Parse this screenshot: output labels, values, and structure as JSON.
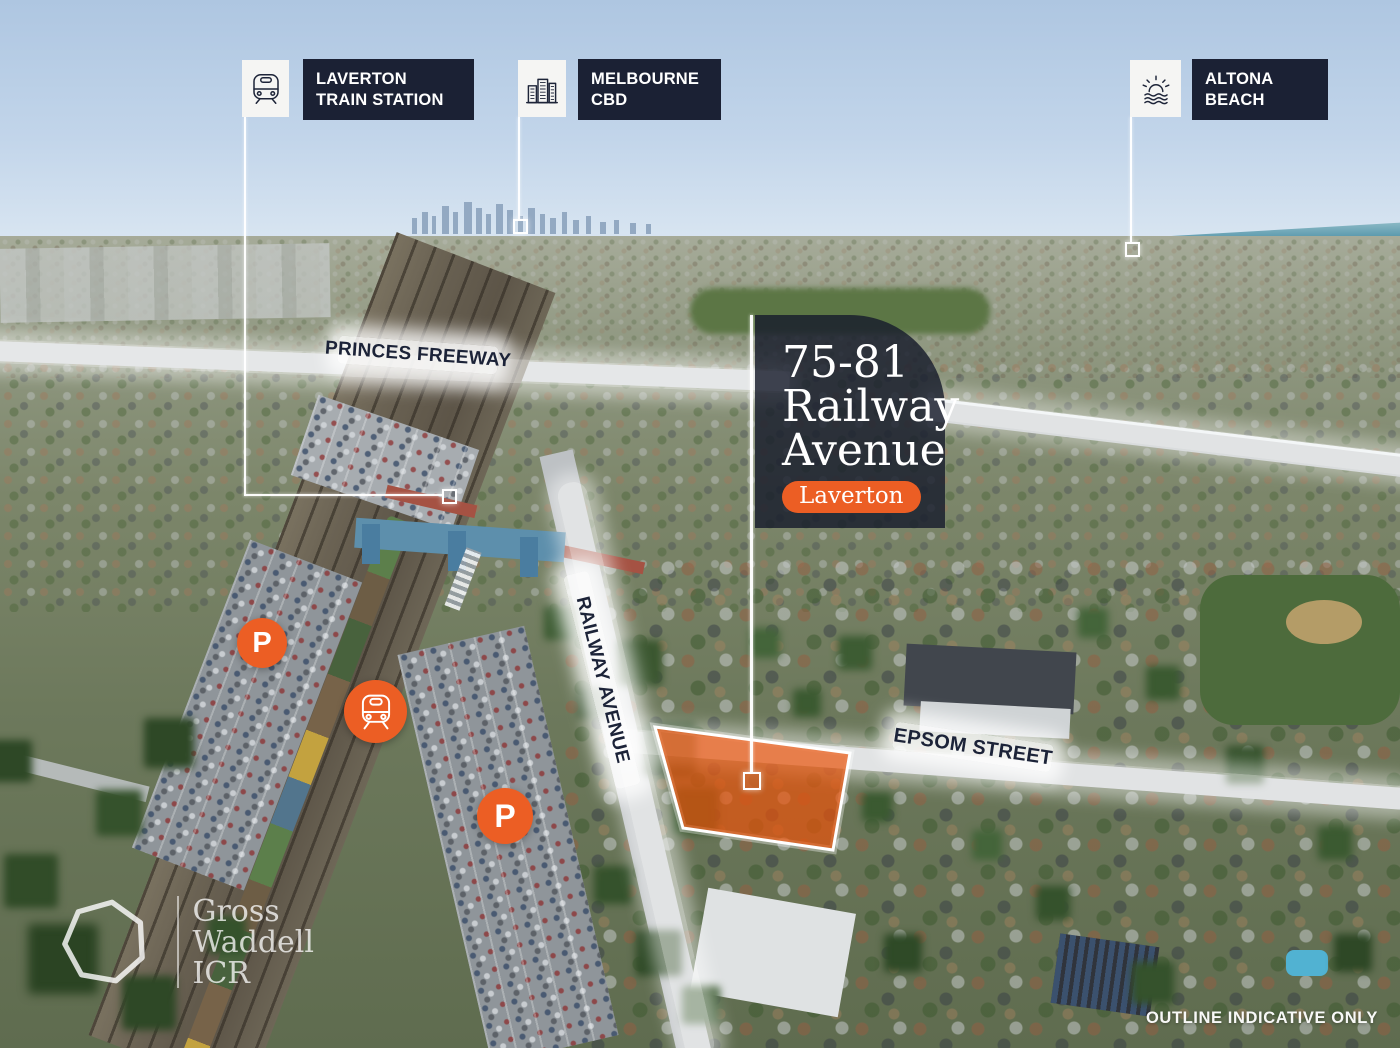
{
  "colors": {
    "accent_orange": "#EC5E24",
    "label_navy": "#1B2134",
    "panel_navy_rgba": "rgba(23,28,44,0.82)",
    "parcel_fill_rgba": "rgba(233,83,10,0.70)",
    "band_white": "#FFFFFF"
  },
  "callouts": [
    {
      "name": "laverton-train-station",
      "icon": "train-icon",
      "line1": "LAVERTON",
      "line2": "TRAIN STATION"
    },
    {
      "name": "melbourne-cbd",
      "icon": "city-buildings-icon",
      "line1": "MELBOURNE",
      "line2": "CBD"
    },
    {
      "name": "altona-beach",
      "icon": "sun-waves-icon",
      "line1": "ALTONA",
      "line2": "BEACH"
    }
  ],
  "property": {
    "address_line1": "75-81",
    "address_line2": "Railway",
    "address_line3": "Avenue",
    "suburb": "Laverton"
  },
  "roads": {
    "princes_freeway": "PRINCES FREEWAY",
    "railway_avenue": "RAILWAY AVENUE",
    "epsom_street": "EPSOM STREET"
  },
  "markers": {
    "parking_label": "P",
    "train_icon": "train-icon"
  },
  "logo": {
    "line1": "Gross",
    "line2": "Waddell",
    "line3": "ICR"
  },
  "footer": {
    "disclaimer": "OUTLINE INDICATIVE ONLY"
  }
}
